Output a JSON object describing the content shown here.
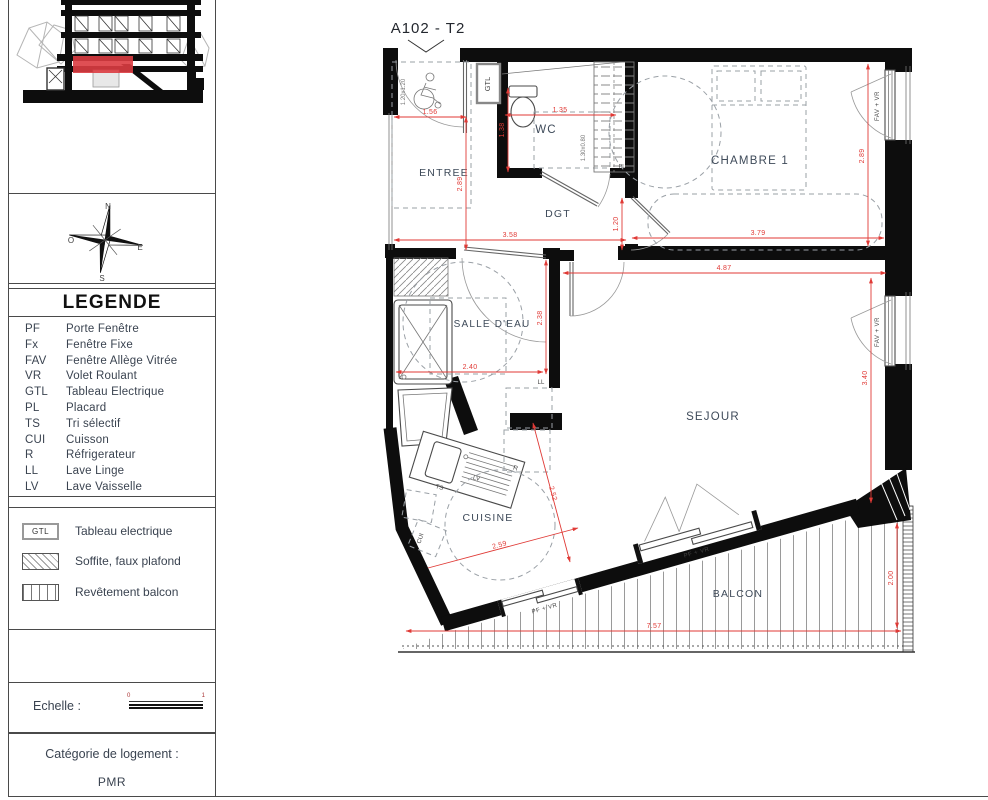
{
  "plan": {
    "title": "A102 - T2",
    "rooms": {
      "entree": "ENTREE",
      "wc": "WC",
      "dgt": "DGT",
      "chambre1": "CHAMBRE 1",
      "salle_deau": "SALLE D'EAU",
      "sejour": "SEJOUR",
      "cuisine": "CUISINE",
      "balcon": "BALCON"
    },
    "equipment": {
      "gtl": "GTL",
      "pl": "PL",
      "ll": "LL",
      "lv": "LV",
      "ts": "TS",
      "r": "R",
      "cui": "CUI"
    },
    "window_labels": {
      "fav_vr": "FAV + VR",
      "pf_vr": "PF + VR"
    },
    "annotations": {
      "wc_size": "1.30x0.80",
      "turn_size": "1.20x1.20"
    },
    "dimensions": {
      "entree_w": "1.56",
      "wc_w": "1.35",
      "wc_h": "1.38",
      "entree_h": "2.89",
      "dgt_w": "3.58",
      "chambre_door": "1.20",
      "chambre_w": "3.79",
      "chambre_h": "2.89",
      "sejour_w": "4.87",
      "sejour_h": "3.40",
      "sdb_w": "2.40",
      "sdb_h": "2.38",
      "cuisine_d1": "2.52",
      "cuisine_d2": "2.59",
      "balcon_w": "7.57",
      "balcon_h": "2.00"
    }
  },
  "sidebar": {
    "compass": {
      "n": "N",
      "e": "E",
      "s": "S",
      "o": "O"
    },
    "legend": {
      "title": "LEGENDE",
      "items": [
        {
          "abbr": "PF",
          "label": "Porte Fenêtre"
        },
        {
          "abbr": "Fx",
          "label": "Fenêtre Fixe"
        },
        {
          "abbr": "FAV",
          "label": "Fenêtre Allège Vitrée"
        },
        {
          "abbr": "VR",
          "label": "Volet Roulant"
        },
        {
          "abbr": "GTL",
          "label": "Tableau Electrique"
        },
        {
          "abbr": "PL",
          "label": "Placard"
        },
        {
          "abbr": "TS",
          "label": "Tri sélectif"
        },
        {
          "abbr": "CUI",
          "label": "Cuisson"
        },
        {
          "abbr": "R",
          "label": "Réfrigerateur"
        },
        {
          "abbr": "LL",
          "label": "Lave Linge"
        },
        {
          "abbr": "LV",
          "label": "Lave Vaisselle"
        }
      ]
    },
    "symbols": {
      "gtl_key": "GTL",
      "items": [
        "Tableau electrique",
        "Soffite, faux plafond",
        "Revêtement balcon"
      ]
    },
    "scale": {
      "label": "Echelle :",
      "start": "0",
      "end": "1"
    },
    "category": {
      "label": "Catégorie de logement :",
      "value": "PMR"
    }
  }
}
